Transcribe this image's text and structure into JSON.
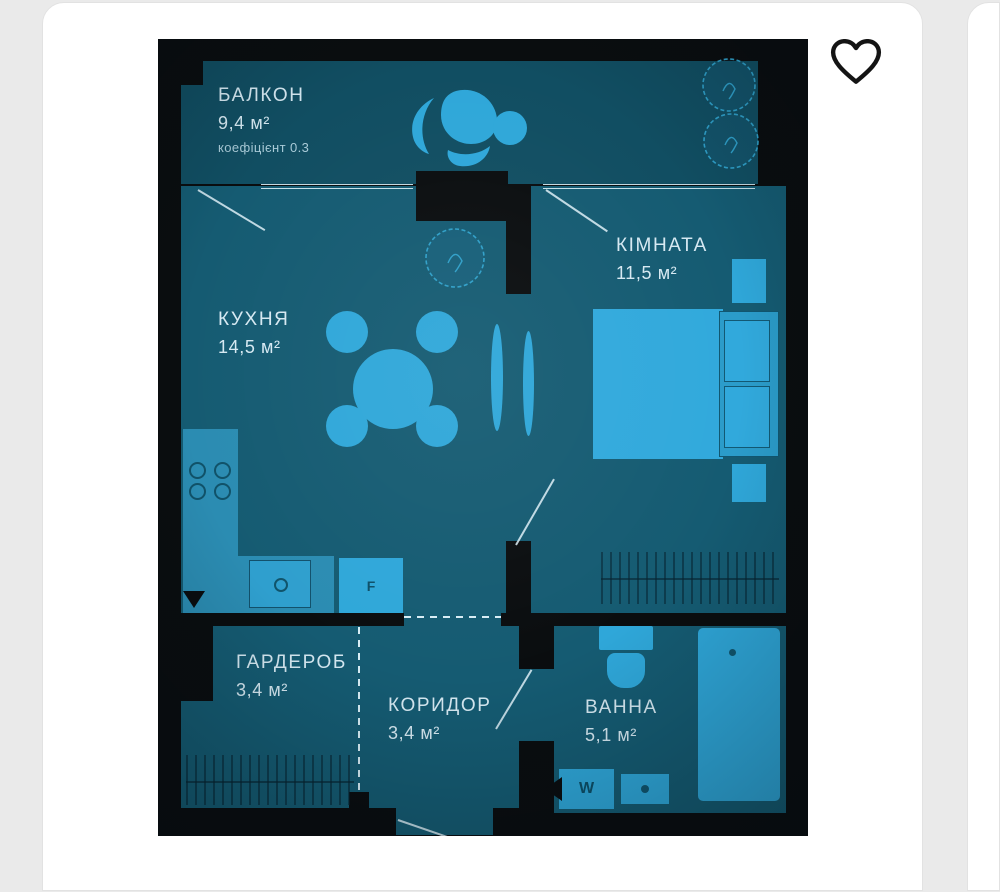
{
  "page": {
    "background": "#eaeaea"
  },
  "listing_card": {
    "favorite": {
      "icon": "heart-outline-icon",
      "state": "inactive"
    }
  },
  "floor_plan": {
    "colors": {
      "walls": "#0a0d0f",
      "floor": "#155b72",
      "floor_balcony": "#114e62",
      "furniture": "#2fa7d9",
      "counter": "#2b8cb2",
      "text": "#d6e9f2",
      "lines": "#d8edf5"
    },
    "rooms": [
      {
        "name": "БАЛКОН",
        "area": "9,4 м²",
        "note": "коефіцієнт 0.3"
      },
      {
        "name": "КУХНЯ",
        "area": "14,5 м²"
      },
      {
        "name": "КІМНАТА",
        "area": "11,5 м²"
      },
      {
        "name": "ГАРДЕРОБ",
        "area": "3,4 м²"
      },
      {
        "name": "КОРИДОР",
        "area": "3,4 м²"
      },
      {
        "name": "ВАННА",
        "area": "5,1 м²"
      }
    ],
    "appliance_labels": {
      "washing_machine": "W",
      "fridge": "F"
    }
  }
}
